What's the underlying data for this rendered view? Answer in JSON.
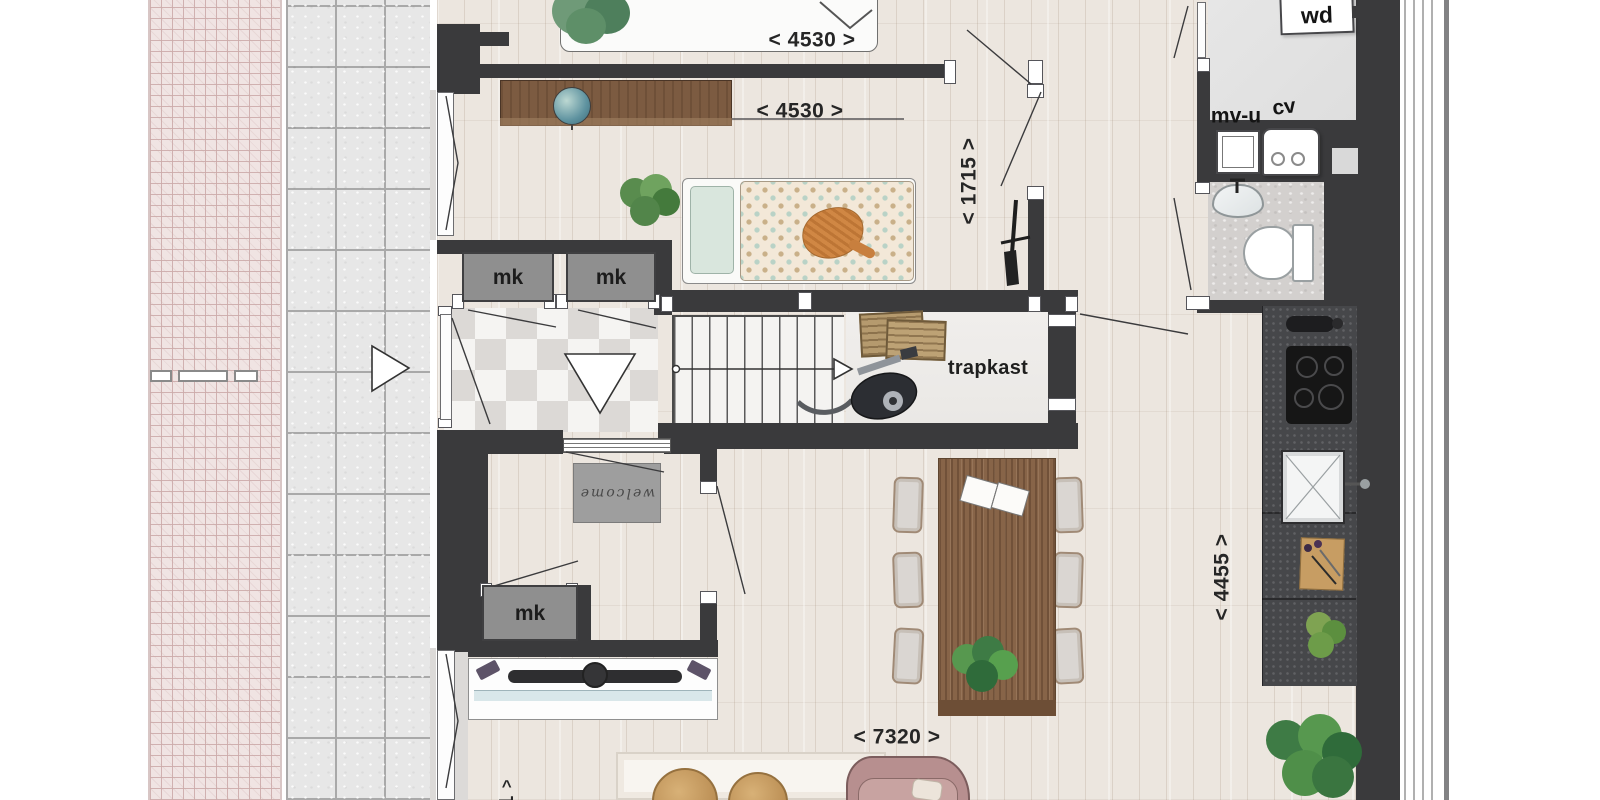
{
  "canvas": {
    "width": 1600,
    "height": 800
  },
  "colors": {
    "wall": "#3a3a3c",
    "wood_floor": "#ece6df",
    "marble_light": "#f5f4f2",
    "marble_dark": "#dcd9d6",
    "stone_tile": "#e7e7e7",
    "stone_grout": "#a9a9a9",
    "brick_paving": "#f0e4e3",
    "brick_line": "#ccabaa",
    "closet_fill": "#8f8f8f",
    "tech_floor": "#e3e3e3",
    "bath_floor": "#d3d0ce",
    "kitchen_counter": "#46474a",
    "hob": "#161616",
    "table_wood": "#876448",
    "sofa": "#b78f8f",
    "rug": "#f8f5f0",
    "pouf": "#c49a62",
    "plant_green": "#548148",
    "doormat_brown": "#b59a6e",
    "welcome_mat_gray": "#9e9e9e"
  },
  "dimensions": {
    "bedroom1_width": "< 4530 >",
    "bedroom2_width": "< 4530 >",
    "door_zone_width": "< 1715 >",
    "kitchen_depth": "< 4455 >",
    "living_width": "< 7320 >",
    "cut_dimension_marker": "^",
    "cut_dimension_digit": "1"
  },
  "rooms": {
    "stair_closet_label": "trapkast"
  },
  "closets": {
    "meter_closet_1": "mk",
    "meter_closet_2": "mk",
    "meter_closet_3": "mk"
  },
  "appliances": {
    "washer_dryer": "wd",
    "mechanical_ventilation": "mv-u",
    "central_heating": "cv"
  },
  "doormat_text": "welcome"
}
